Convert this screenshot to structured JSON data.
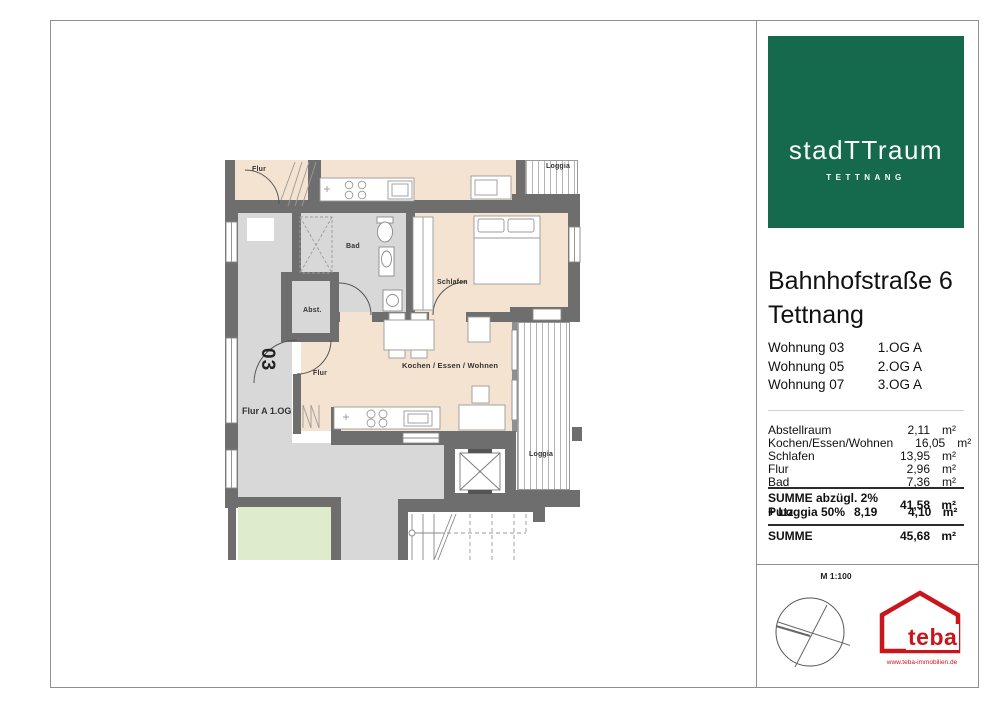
{
  "colors": {
    "logo_green": "#15694d",
    "teba_red": "#c9161d",
    "wall_gray": "#6e6e6e",
    "floor_beige": "#f4e3d1"
  },
  "sidebar": {
    "logo": {
      "brand": "stadTTraum",
      "subtitle": "TETTNANG"
    },
    "address": {
      "line1": "Bahnhofstraße 6",
      "line2": "Tettnang"
    },
    "units": [
      {
        "name": "Wohnung 03",
        "floor": "1.OG A"
      },
      {
        "name": "Wohnung 05",
        "floor": "2.OG A"
      },
      {
        "name": "Wohnung 07",
        "floor": "3.OG A"
      }
    ],
    "areas": [
      {
        "name": "Abstellraum",
        "value": "2,11",
        "unit": "m²"
      },
      {
        "name": "Kochen/Essen/Wohnen",
        "value": "16,05",
        "unit": "m²"
      },
      {
        "name": "Schlafen",
        "value": "13,95",
        "unit": "m²"
      },
      {
        "name": "Flur",
        "value": "2,96",
        "unit": "m²"
      },
      {
        "name": "Bad",
        "value": "7,36",
        "unit": "m²"
      }
    ],
    "subtotal": {
      "label": "SUMME abzügl. 2% Putz",
      "value": "41,58",
      "unit": "m²"
    },
    "loggia_row": {
      "label": "+ Loggia 50%",
      "gross": "8,19",
      "value": "4,10",
      "unit": "m²"
    },
    "total": {
      "label": "SUMME",
      "value": "45,68",
      "unit": "m²"
    }
  },
  "plan": {
    "labels": {
      "flur_top": "Flur",
      "bad": "Bad",
      "abst": "Abst.",
      "schlafen": "Schlafen",
      "kochen": "Kochen / Essen / Wohnen",
      "flur": "Flur",
      "loggia": "Loggia",
      "loggia_top": "Loggia",
      "unit_no": "03",
      "hall": "Flur A 1.OG"
    }
  },
  "footer": {
    "scale": "M 1:100",
    "teba": "teba",
    "website": "www.teba-immobilien.de"
  }
}
